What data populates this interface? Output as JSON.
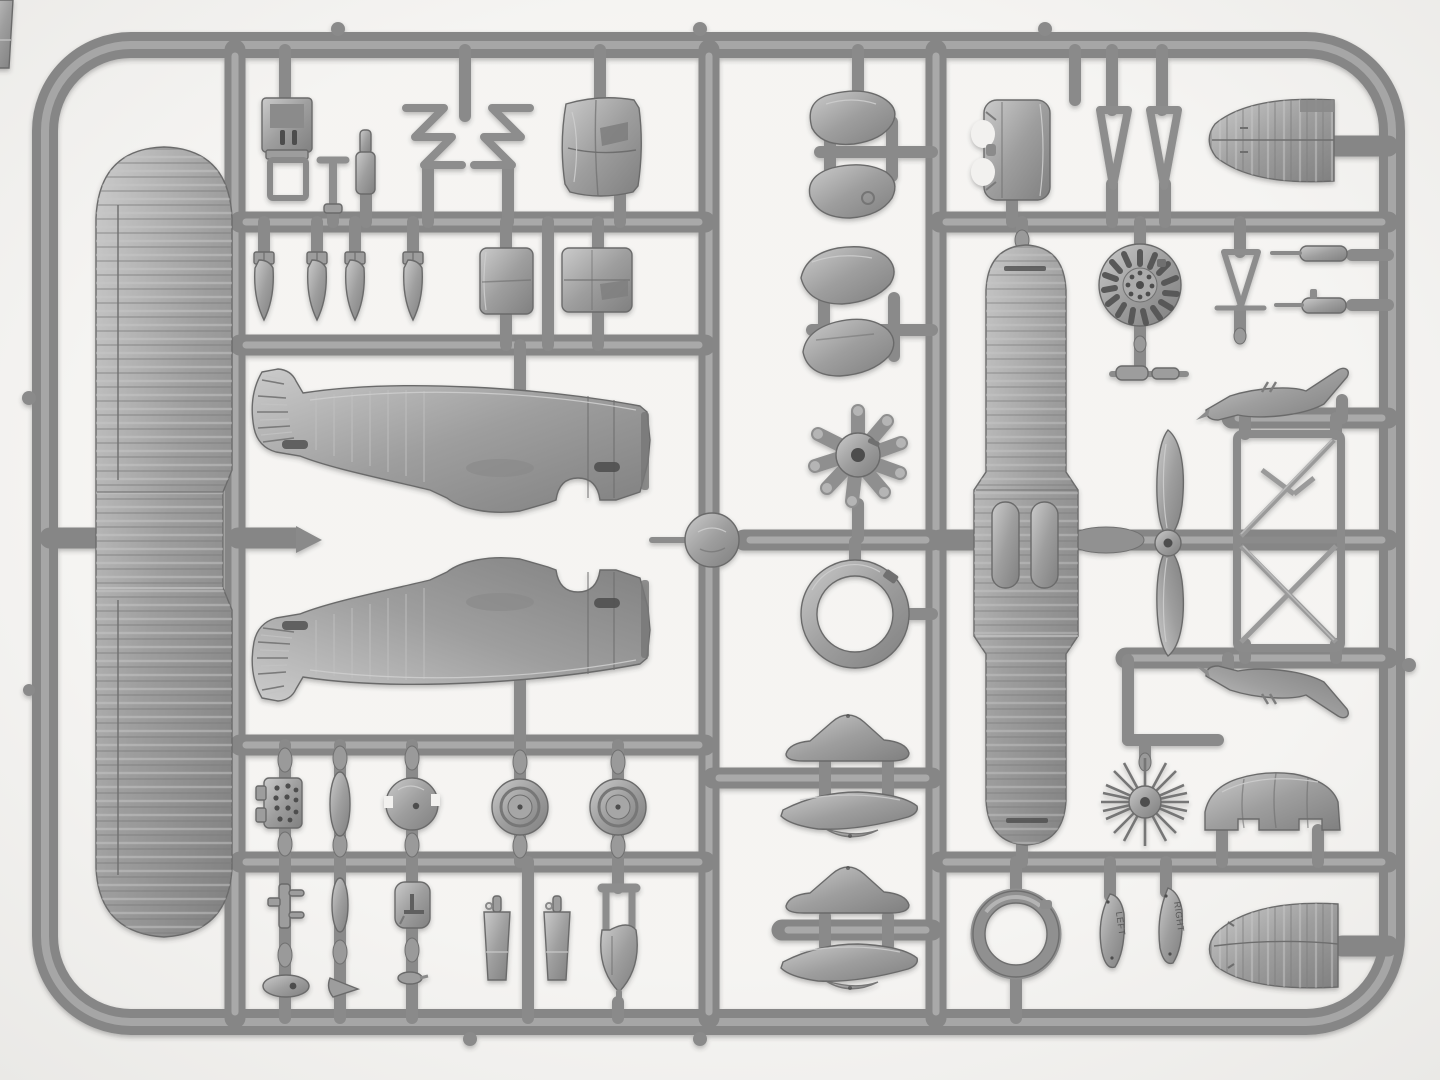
{
  "scene": {
    "type": "photograph",
    "subject": "Injection-molded gray polystyrene sprue (parts tree) of a small-scale radial-engine fighter aircraft model kit, shot top-down on a white background",
    "background_color": "#f2f1ef",
    "lighting": "soft even light, subtle drop shadow under the plastic"
  },
  "palette": {
    "background": "#f2f1ef",
    "vignette": "#e6e5e2",
    "plastic_mid": "#9b9b9b",
    "plastic_light": "#cacaca",
    "plastic_dark": "#6e6e6e",
    "plastic_deep": "#4d4d4d",
    "runner": "#868686",
    "runner_highlight": "#b4b4b4"
  },
  "embossed_labels": {
    "left_blade": "LEFT",
    "right_blade": "RIGHT"
  },
  "sprue": {
    "frame": {
      "shape": "rounded rectangle",
      "corner_radius_px": 85,
      "bar_thickness_px": 26
    },
    "runner_layout": "three full-height vertical runners divide the tree into four columns; multiple horizontal runners carry the parts",
    "parts": [
      {
        "name": "one-piece-lower-wing",
        "desc": "long fabric-ribbed wing, vertical at far left"
      },
      {
        "name": "fuselage-half-port",
        "desc": "stubby fighter fuselage half, tail left / open cowl nose right"
      },
      {
        "name": "fuselage-half-starboard",
        "desc": "mirrored fuselage half below the first"
      },
      {
        "name": "pilot-seat",
        "desc": "seat back with slots and tubular frame, top left"
      },
      {
        "name": "control-column",
        "desc": "small T-shaped stick"
      },
      {
        "name": "machine-gun-barrel",
        "desc": "stepped cylinder"
      },
      {
        "name": "windscreen-frame-pair",
        "desc": "two mirrored zig-zag wire frames"
      },
      {
        "name": "cowling-side-panel",
        "desc": "curved rectangular panel with notched corners"
      },
      {
        "name": "fuselage-access-panels",
        "desc": "two curved rectangular panels"
      },
      {
        "name": "bombs",
        "desc": "four small finned bombs hanging from a runner"
      },
      {
        "name": "instrument-panel",
        "desc": "small plate drilled with dial holes"
      },
      {
        "name": "fuel-tank-pods",
        "desc": "spindle-shaped fairings molded in-line on droppers"
      },
      {
        "name": "headrest-fairing",
        "desc": "round dome with side notches and centre hole"
      },
      {
        "name": "engine-mount-bracket",
        "desc": "bar with two side pins"
      },
      {
        "name": "data-pad-with-T-mark",
        "desc": "rounded square pad, engraved T"
      },
      {
        "name": "grab-handle-oval",
        "desc": "flat oval with hole"
      },
      {
        "name": "aiming-cone",
        "desc": "tiny pointed cone"
      },
      {
        "name": "small-bomb",
        "desc": "tiny elongated drop"
      },
      {
        "name": "main-wheels",
        "desc": "two disc wheels with hubs"
      },
      {
        "name": "exhaust-cones",
        "desc": "two tapered stacks with top pins"
      },
      {
        "name": "tail-wheel-fork-fairing",
        "desc": "fork over teardrop body with spike"
      },
      {
        "name": "molding-boss",
        "desc": "round pad at centre runner crossing"
      },
      {
        "name": "teardrop-fairing-halves-round",
        "desc": "two smooth teardrop halves around a cross runner"
      },
      {
        "name": "teardrop-fairing-halves-pointed",
        "desc": "two pointed teardrop halves around a cross runner"
      },
      {
        "name": "nine-cylinder-radial-engine",
        "desc": "star engine with nine finned cylinders"
      },
      {
        "name": "engine-cowling-ring",
        "desc": "open annular cowl ring"
      },
      {
        "name": "wheel-spat-halves",
        "desc": "four spat halves: two domed plan views, two keeled canoe views"
      },
      {
        "name": "one-piece-upper-wing",
        "desc": "vertical centre wing with widened centre-section and twin root fairings"
      },
      {
        "name": "two-blade-propeller",
        "desc": "slender two-blade prop, hub on centre runner"
      },
      {
        "name": "engine-cowling-front",
        "desc": "barrel cowl with scalloped edge, top right"
      },
      {
        "name": "landing-gear-v-struts",
        "desc": "two narrow triangular V struts"
      },
      {
        "name": "horizontal-stabilizer",
        "desc": "ribbed rounded stabilizer with elevator hinge line, top right"
      },
      {
        "name": "cooling-louvre-disc",
        "desc": "disc with radial louvre slots and drilled centre"
      },
      {
        "name": "bracing-triangle",
        "desc": "inverted triangle frame with cross bar"
      },
      {
        "name": "fuselage-machine-guns",
        "desc": "two small gun bodies with thin barrels, right edge"
      },
      {
        "name": "exhaust-stub-cylinders",
        "desc": "two tiny cylinders on a thin bar"
      },
      {
        "name": "tail-skids",
        "desc": "two mirrored horned skid castings"
      },
      {
        "name": "cockpit-frame-truss",
        "desc": "two-bay tubular truss with diagonals"
      },
      {
        "name": "wire-spoked-wheel",
        "desc": "hub with radiating wire spokes, no rim"
      },
      {
        "name": "cowling-hump-panel",
        "desc": "humped panel with notched base"
      },
      {
        "name": "tyre-ring",
        "desc": "open ring (tyre) lower right"
      },
      {
        "name": "propeller-blade-left",
        "desc": "separate blade embossed LEFT"
      },
      {
        "name": "propeller-blade-right",
        "desc": "separate blade embossed RIGHT"
      },
      {
        "name": "ribbed-tail-surface",
        "desc": "fan-shaped ribbed surface, bottom right corner"
      }
    ]
  }
}
